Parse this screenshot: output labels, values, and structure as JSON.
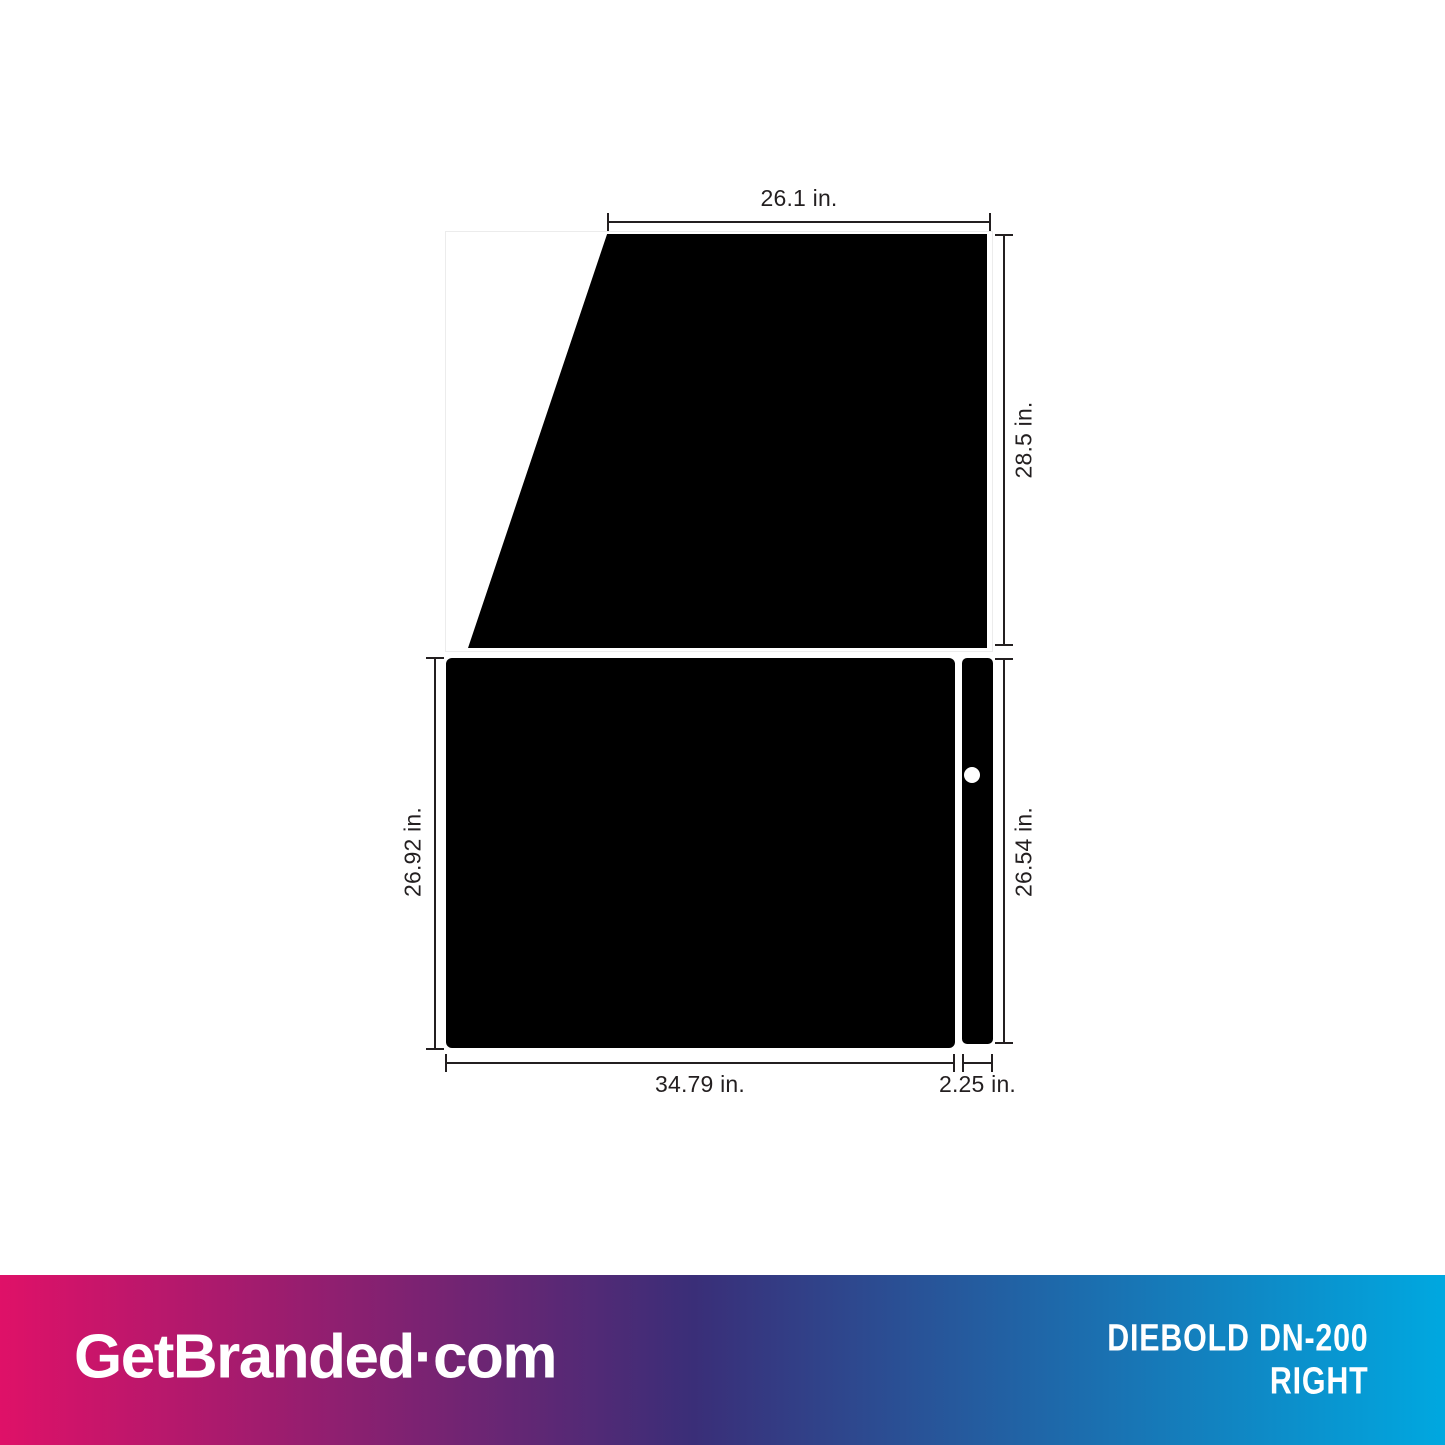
{
  "diagram": {
    "title": "Diebold DN-200 right-side wrap template",
    "dimensions": {
      "top_width": "26.1 in.",
      "top_height": "28.5 in.",
      "main_height": "26.92 in.",
      "main_width": "34.79 in.",
      "strip_height": "26.54 in.",
      "strip_width": "2.25 in."
    }
  },
  "footer": {
    "brand": "GetBranded",
    "brand_suffix": "·com",
    "product_line1": "DIEBOLD DN-200",
    "product_line2": "RIGHT"
  },
  "colors": {
    "panel": "#000000",
    "dimension_lines": "#231f20",
    "gradient_left": "#DF1168",
    "gradient_mid": "#3A2E78",
    "gradient_right": "#00A8E0"
  }
}
